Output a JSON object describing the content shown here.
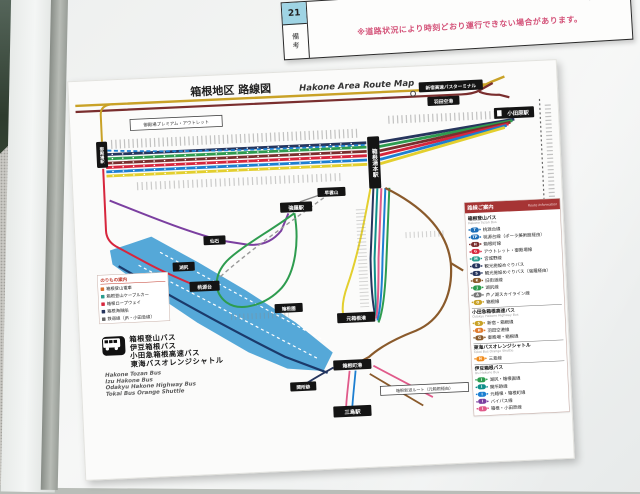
{
  "timetable": {
    "row_number": "21",
    "remarks_label": "備考",
    "notice": "※道路状況により時刻どおり運行できない場合があります。",
    "code": "11602-02"
  },
  "poster": {
    "title_jp": "箱根地区 路線図",
    "title_en": "Hakone Area Route Map",
    "stations": {
      "shinjuku": "新宿高速バスターミナル",
      "haneda": "羽田空港",
      "odawara": "小田原駅",
      "yumoto": "箱根湯本駅",
      "gotemba": "御殿場駅",
      "gora": "強羅駅",
      "sounzan": "早雲山",
      "sengoku": "仙石",
      "kojiri": "湖尻",
      "togendai": "桃源台",
      "hakoneen": "箱根園",
      "motohakone": "元箱根港",
      "hakonemachi": "箱根町港",
      "sekisho": "関所跡",
      "mishima": "三島駅"
    },
    "notes": {
      "outlet": "御殿場プレミアム・アウトレット",
      "shindo": "箱根新道ルート（元箱根経由）"
    },
    "mini_legend": {
      "title": "のりもの案内",
      "items": [
        {
          "label": "箱根登山電車",
          "color": "#d96c2c"
        },
        {
          "label": "箱根登山ケーブルカー",
          "color": "#2a9d8f"
        },
        {
          "label": "箱根ロープウェイ",
          "color": "#d7263d"
        },
        {
          "label": "箱根海賊船",
          "color": "#26355d"
        },
        {
          "label": "鉄道線（JR・小田急線）",
          "color": "#666666"
        }
      ]
    },
    "operators": {
      "jp": [
        "箱根登山バス",
        "伊豆箱根バス",
        "小田急箱根高速バス",
        "東海バスオレンジシャトル"
      ],
      "en": [
        "Hakone Tozan Bus",
        "Izu Hakone Bus",
        "Odakyu Hakone Highway Bus",
        "Tokai Bus Orange Shuttle"
      ]
    },
    "route_legend": {
      "title_jp": "路線ご案内",
      "title_en": "Route Information",
      "sections": [
        {
          "name_jp": "箱根登山バス",
          "name_en": "Hakone Tozan Bus",
          "items": [
            {
              "badge": "T",
              "color": "#1d6fb8",
              "label": "桃源台線"
            },
            {
              "badge": "TP",
              "color": "#1d6fb8",
              "label": "桃源台線（ポーラ美術館経由）"
            },
            {
              "badge": "H",
              "color": "#7a2e2e",
              "label": "箱根町線"
            },
            {
              "badge": "G",
              "color": "#d7263d",
              "label": "アウトレット・御殿場線"
            },
            {
              "badge": "M",
              "color": "#2a9d8f",
              "label": "宮城野線"
            },
            {
              "badge": "S",
              "color": "#26355d",
              "label": "観光施設めぐりバス"
            },
            {
              "badge": "S",
              "color": "#26355d",
              "label": "観光施設めぐりバス（強羅経由）"
            },
            {
              "badge": "K",
              "color": "#8a5a2b",
              "label": "旧街道線"
            },
            {
              "badge": "J",
              "color": "#2e9c4f",
              "label": "湖尻線"
            },
            {
              "badge": "A",
              "color": "#777777",
              "label": "芦ノ湖スカイライン線"
            },
            {
              "badge": "O",
              "color": "#c9a227",
              "label": "箱根線"
            }
          ]
        },
        {
          "name_jp": "小田急箱根高速バス",
          "name_en": "Odakyu Hakone Highway Bus",
          "items": [
            {
              "badge": "S",
              "color": "#c9a227",
              "label": "新宿・箱根線"
            },
            {
              "badge": "H",
              "color": "#e07b2f",
              "label": "羽田空港線"
            },
            {
              "badge": "G",
              "color": "#8a5a2b",
              "label": "御殿場・箱根線"
            }
          ]
        },
        {
          "name_jp": "東海バスオレンジシャトル",
          "name_en": "Tokai Bus Orange Shuttle",
          "items": [
            {
              "badge": "N",
              "color": "#f08c1e",
              "label": "三島線"
            }
          ]
        },
        {
          "name_jp": "伊豆箱根バス",
          "name_en": "Izu Hakone Bus",
          "items": [
            {
              "badge": "I",
              "color": "#2e9c4f",
              "label": "湖尻・箱根園線"
            },
            {
              "badge": "I",
              "color": "#0f8f8a",
              "label": "関所跡線"
            },
            {
              "badge": "I",
              "color": "#1d7fd1",
              "label": "元箱根・箱根町線"
            },
            {
              "badge": "I",
              "color": "#7b3fa0",
              "label": "バイパス線"
            },
            {
              "badge": "I",
              "color": "#e05a8a",
              "label": "箱根・小田原線"
            }
          ]
        }
      ]
    },
    "colors": {
      "lake": "#55a8d8",
      "line_navy": "#26355d",
      "line_green": "#2e9c4f",
      "line_maroon": "#7a2e2e",
      "line_red": "#d7263d",
      "line_blue": "#1d7fd1",
      "line_yellow": "#e3cf2e",
      "line_gold": "#c9a227",
      "line_purple": "#7b3fa0",
      "line_teal": "#0f8f8a",
      "line_pink": "#e05a8a",
      "line_brown": "#8a5a2b",
      "legend_header": "#a63434",
      "notice_text": "#d4547a"
    }
  }
}
